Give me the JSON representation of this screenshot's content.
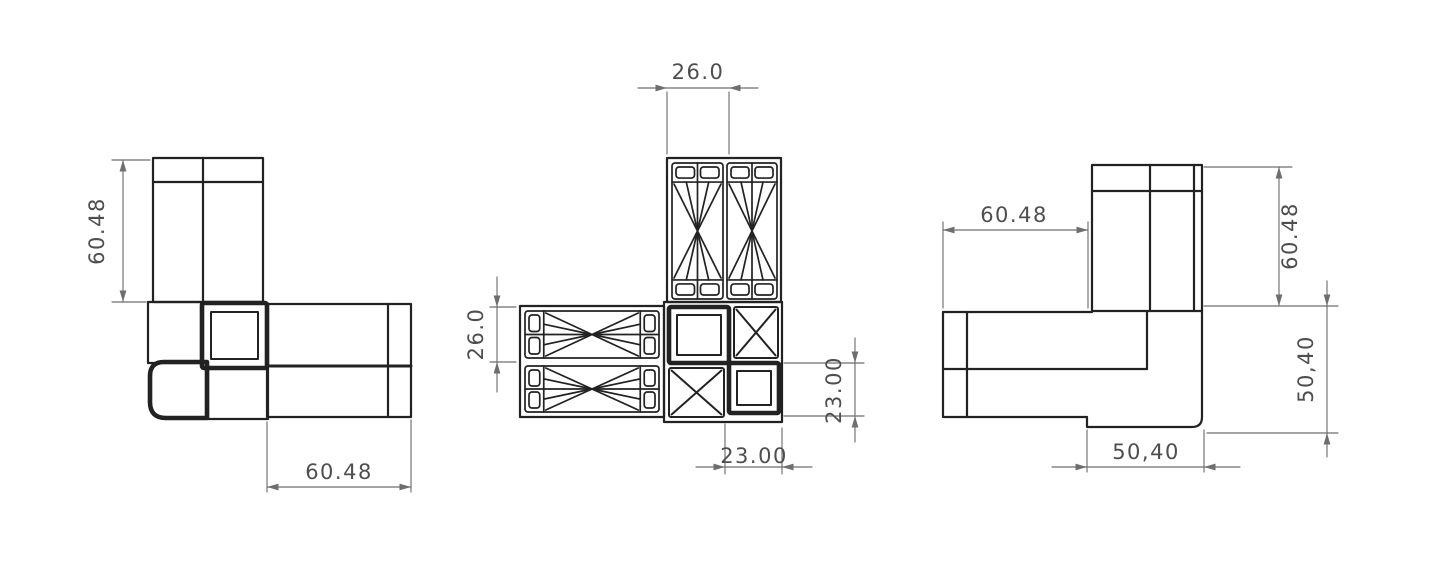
{
  "drawing": {
    "colors": {
      "background": "#ffffff",
      "line_color": "#222222",
      "dimension_line_color": "#6e6e6e",
      "dimension_text_color": "#4e4e4e"
    },
    "views": {
      "left": {
        "dims": {
          "vertical": "60.48",
          "horizontal": "60.48"
        }
      },
      "middle": {
        "dims": {
          "top": "26.0",
          "left": "26.0",
          "right": "23.00",
          "bottom": "23.00"
        }
      },
      "right": {
        "dims": {
          "top": "60.48",
          "right_upper": "60.48",
          "right_lower": "50,40",
          "bottom": "50,40"
        }
      }
    }
  }
}
